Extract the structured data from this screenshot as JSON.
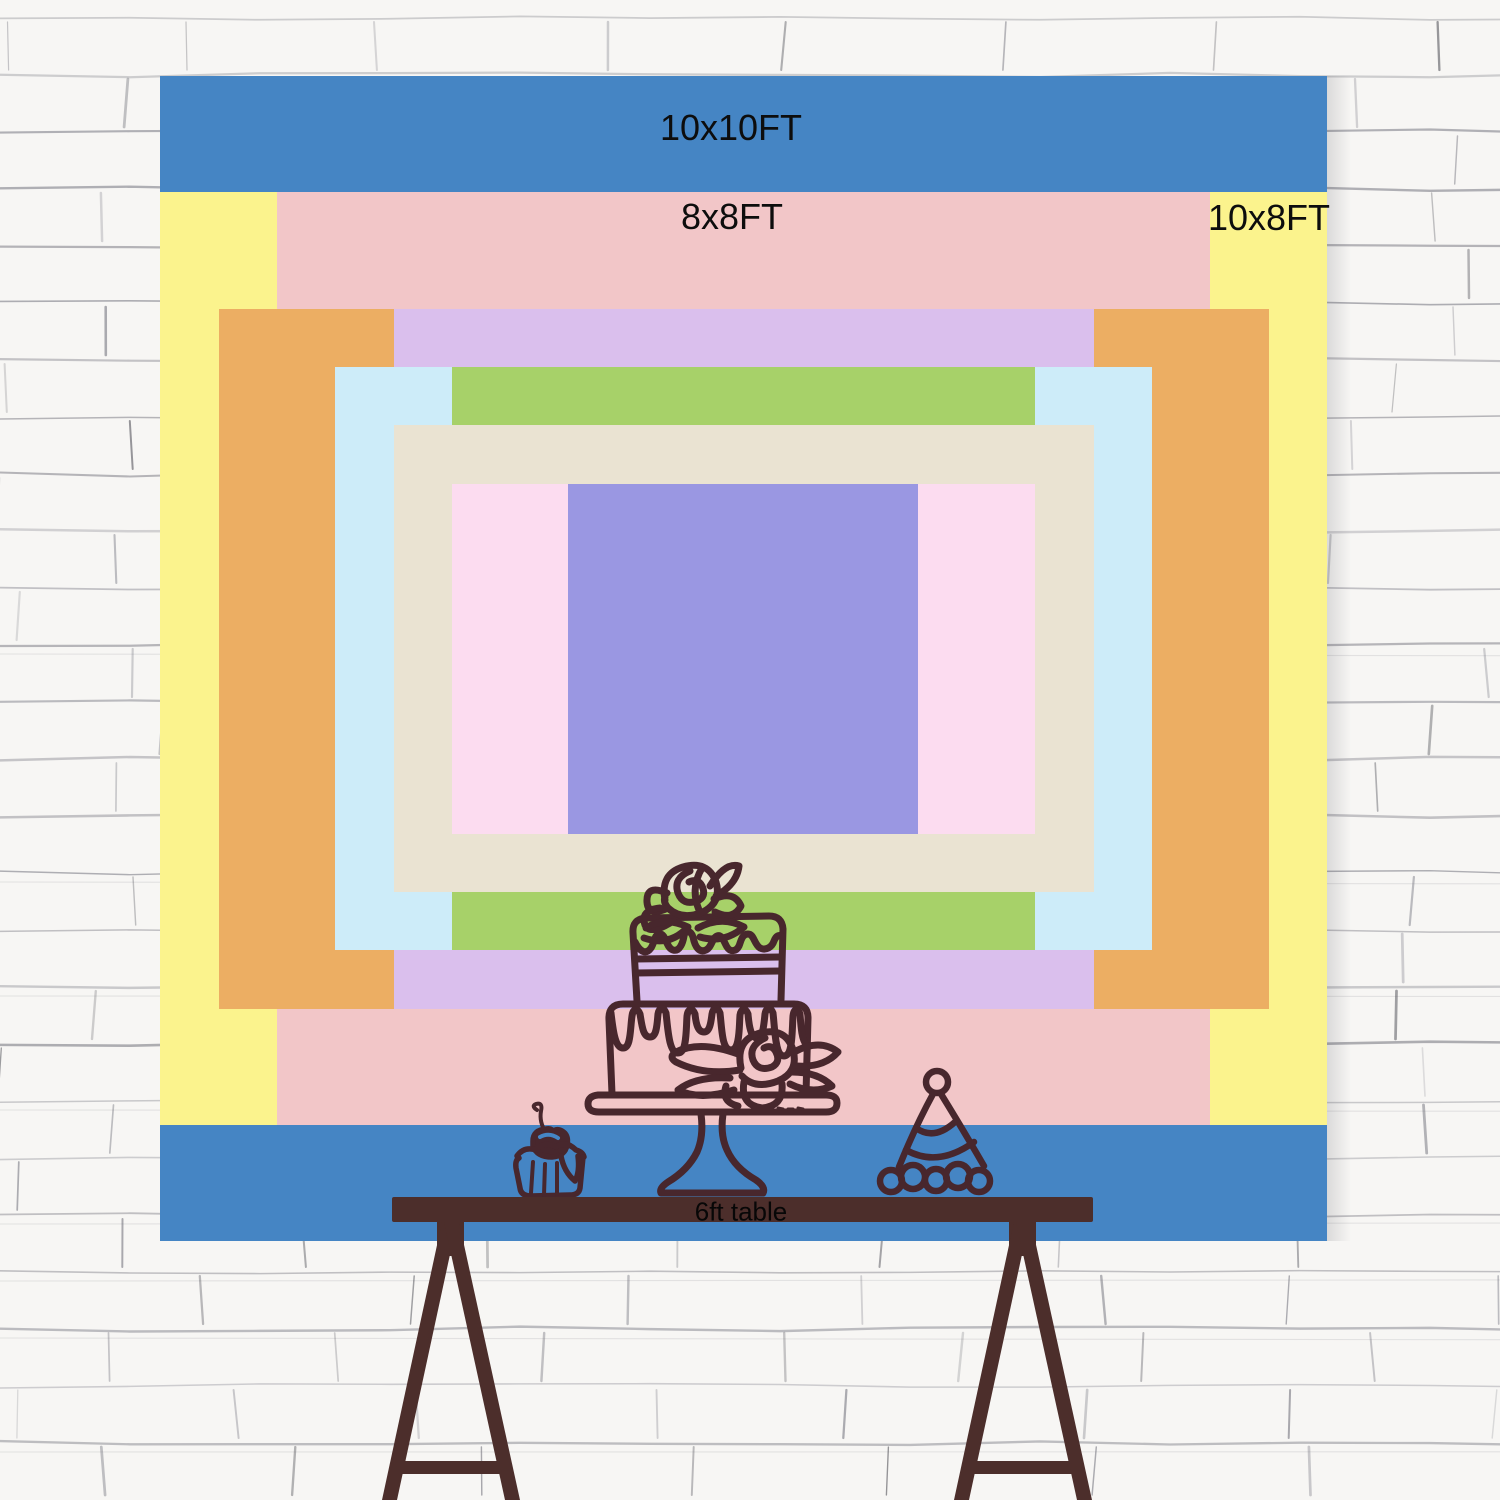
{
  "chart_title": "backdrop size chart",
  "board": {
    "sizes": [
      {
        "id": "10x10",
        "label": "10x10FT",
        "color": "#4585c4",
        "x": 160,
        "y": 76,
        "w": 1167,
        "h": 1165,
        "label_x": 731,
        "label_y": 128
      },
      {
        "id": "10x8",
        "label": "10x8FT",
        "color": "#fbf38d",
        "x": 160,
        "y": 192,
        "w": 1167,
        "h": 933,
        "label_x": 1269,
        "label_y": 218
      },
      {
        "id": "8x8",
        "label": "8x8FT",
        "color": "#f2c6c8",
        "x": 277,
        "y": 192,
        "w": 933,
        "h": 933,
        "label_x": 732,
        "label_y": 217
      },
      {
        "id": "9x6",
        "label": "9x6FT",
        "color": "#ecae63",
        "x": 219,
        "y": 309,
        "w": 1050,
        "h": 700,
        "label_x": 1212,
        "label_y": 339
      },
      {
        "id": "6x6",
        "label": "6x6FT",
        "color": "#dabfed",
        "x": 394,
        "y": 309,
        "w": 700,
        "h": 700,
        "label_x": 733,
        "label_y": 341
      },
      {
        "id": "7x5",
        "label": "7x5FT",
        "color": "#cdecf9",
        "x": 335,
        "y": 367,
        "w": 817,
        "h": 583,
        "label_x": 1100,
        "label_y": 397
      },
      {
        "id": "5x5",
        "label": "5x5FT",
        "color": "#a7d169",
        "x": 452,
        "y": 367,
        "w": 583,
        "h": 583,
        "label_x": 732,
        "label_y": 397
      },
      {
        "id": "6x4",
        "label": "6x4FT",
        "color": "#eae3d2",
        "x": 394,
        "y": 425,
        "w": 700,
        "h": 467,
        "label_x": 1030,
        "label_y": 446
      },
      {
        "id": "5x3",
        "label": "5x3FT",
        "color": "#fcdcf0",
        "x": 452,
        "y": 484,
        "w": 583,
        "h": 350,
        "label_x": 978,
        "label_y": 509
      },
      {
        "id": "3x3",
        "label": "3x3FT",
        "color": "#9a97e2",
        "x": 568,
        "y": 484,
        "w": 350,
        "h": 350,
        "label_x": 733,
        "label_y": 510
      }
    ]
  },
  "table": {
    "label": "6ft table"
  },
  "decor_icons": [
    "tiered-cake-doodle",
    "cupcake-doodle",
    "party-hat-doodle",
    "trestle-table"
  ],
  "colors": {
    "wall": "#f7f6f4",
    "wall_line": "#6d6d78",
    "label_text": "#0d0d0d",
    "furniture_brown": "#4c2e2b",
    "doodle_stroke": "#48272d",
    "cherry_highlight": "#4585c4"
  }
}
